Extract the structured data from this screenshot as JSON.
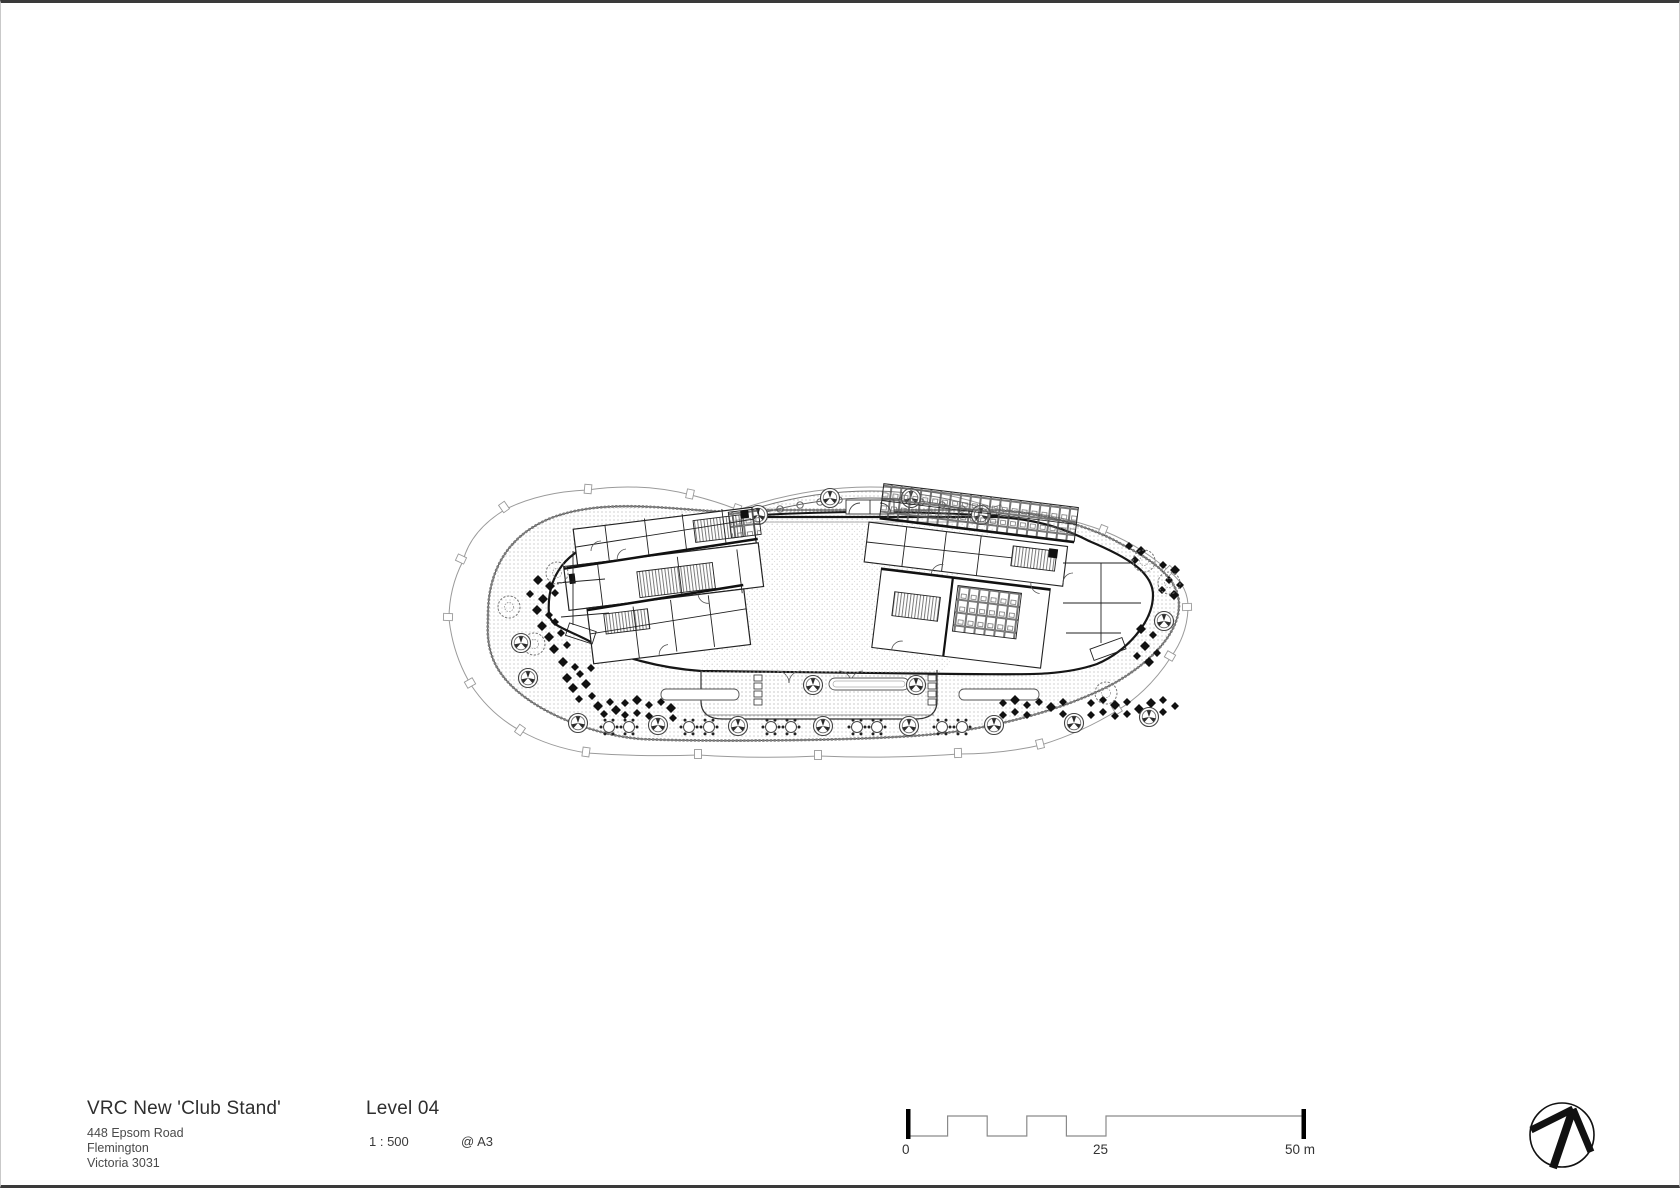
{
  "page": {
    "background": "#ffffff",
    "frame_dark": "#3a3a3a",
    "frame_light": "#c9c9c9",
    "ink": "#1a1a1a",
    "light_line": "#9a9a9a"
  },
  "title_block": {
    "project_title": "VRC New 'Club Stand'",
    "address_lines": [
      "448 Epsom Road",
      "Flemington",
      "Victoria 3031"
    ]
  },
  "drawing_info": {
    "level_label": "Level 04",
    "scale_label": "1 : 500",
    "sheet_label": "@ A3"
  },
  "scale_bar": {
    "start_label": "0",
    "mid_label": "25",
    "end_label": "50 m",
    "total_meters": 50
  },
  "icons": {
    "north_arrow": "north-arrow-icon"
  }
}
